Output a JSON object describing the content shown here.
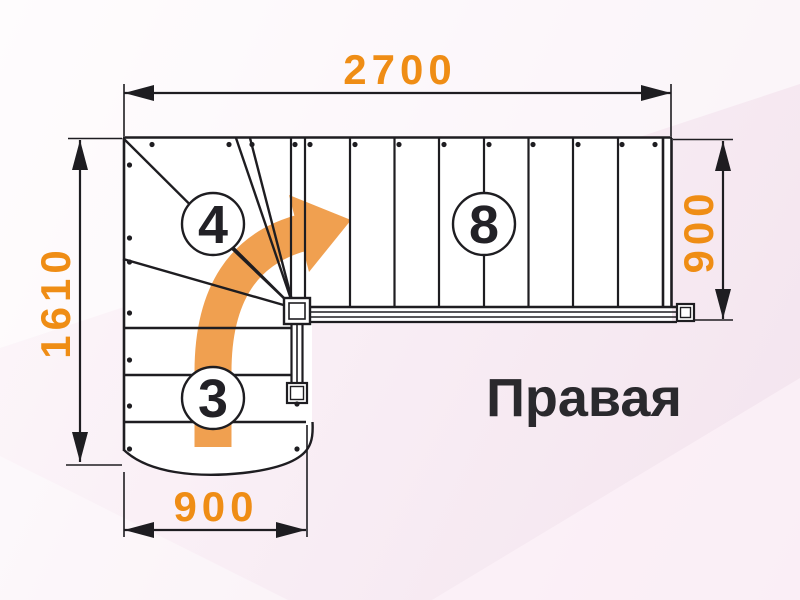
{
  "diagram": {
    "title_label": "Правая",
    "dimensions": {
      "top_width": "2700",
      "left_height": "1610",
      "right_height": "900",
      "bottom_width": "900"
    },
    "step_counts": {
      "upper_flight": "8",
      "winder_turn": "4",
      "lower_flight": "3"
    },
    "colors": {
      "dimension_text": "#EF8D15",
      "direction_arrow": "#F0A050",
      "linework": "#1E1D21",
      "background": "#F7ECF2"
    }
  }
}
